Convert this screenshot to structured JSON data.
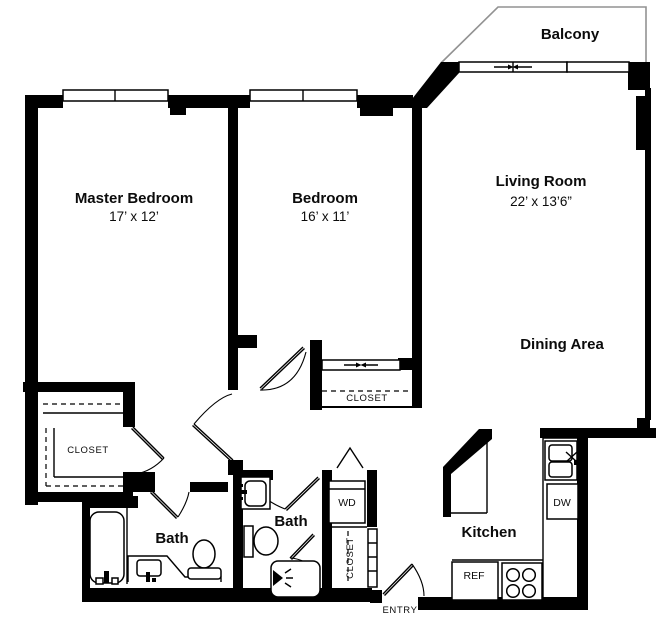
{
  "colors": {
    "wall": "#000000",
    "balcony_outline": "#929292",
    "background": "#ffffff"
  },
  "balcony": {
    "label": "Balcony"
  },
  "rooms": [
    {
      "name": "Master Bedroom",
      "dims": "17’ x 12’"
    },
    {
      "name": "Bedroom",
      "dims": "16’ x 11’"
    },
    {
      "name": "Living Room",
      "dims": "22’ x 13’6”"
    },
    {
      "name": "Dining Area"
    },
    {
      "name": "Kitchen"
    },
    {
      "name": "Bath"
    },
    {
      "name": "Bath"
    }
  ],
  "closets": {
    "master": "CLOSET",
    "bedroom": "CLOSET",
    "hall": "CLOSET"
  },
  "appliances": {
    "washer_dryer": "WD",
    "dishwasher": "DW",
    "refrigerator": "REF"
  },
  "entry_label": "ENTRY"
}
